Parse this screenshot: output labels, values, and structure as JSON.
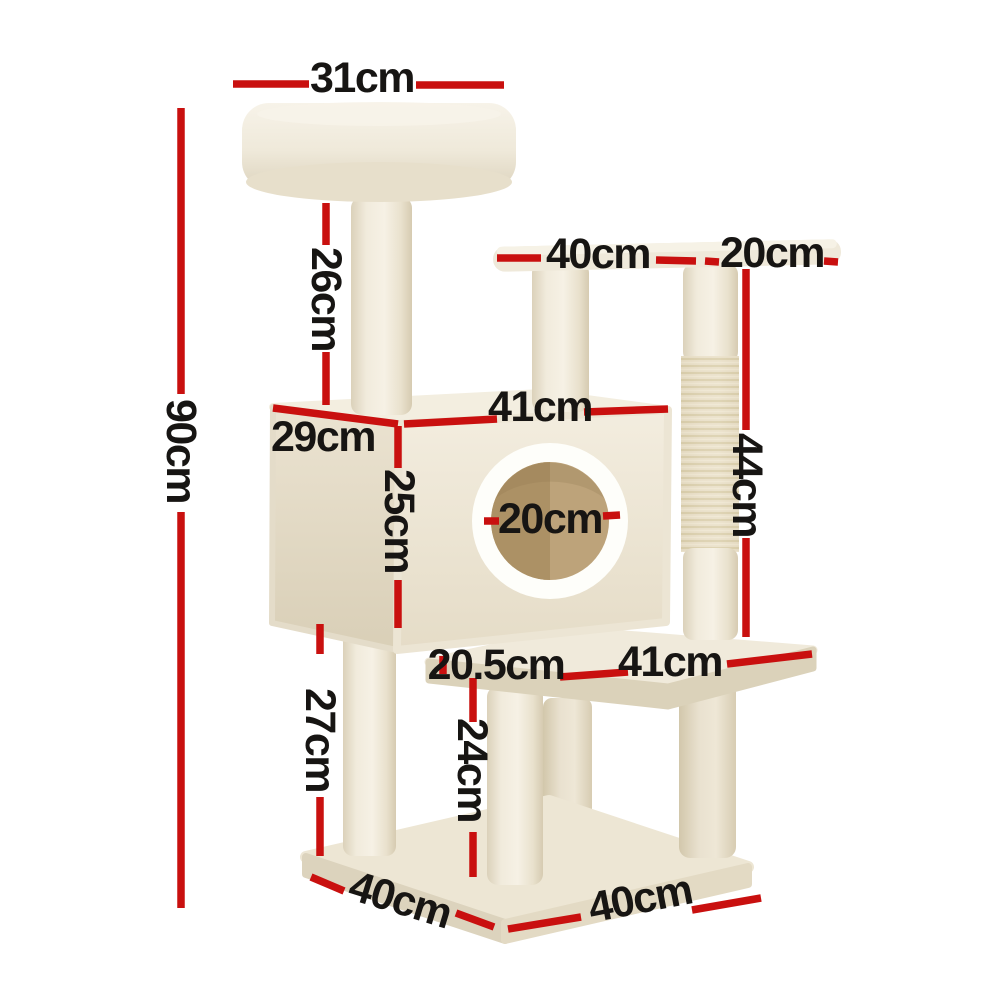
{
  "image": {
    "description": "Beige plush cat tree / scratching post product photo annotated with red dimension lines",
    "background": "#ffffff"
  },
  "colors": {
    "dimension_line": "#c9100f",
    "label_text": "#171513",
    "plush_light": "#f4efe3",
    "plush_mid": "#ece4d2",
    "plush_shadow": "#dcd2bb",
    "sisal": "#eae0c8",
    "hole_ring": "#fefefa",
    "hole_inner": "#bda37a",
    "hole_inner_dark": "#ac9165"
  },
  "dimensions": {
    "top_bed_width": {
      "label": "31cm"
    },
    "total_height": {
      "label": "90cm"
    },
    "top_post_height": {
      "label": "26cm"
    },
    "mid_platform_length": {
      "label": "40cm"
    },
    "mid_platform_overhang": {
      "label": "20cm"
    },
    "condo_width": {
      "label": "41cm"
    },
    "condo_depth": {
      "label": "29cm"
    },
    "condo_height": {
      "label": "25cm"
    },
    "hole_diameter": {
      "label": "20cm"
    },
    "sisal_post_height": {
      "label": "44cm"
    },
    "lower_platform_inset": {
      "label": "20.5cm"
    },
    "lower_platform_length": {
      "label": "41cm"
    },
    "left_post_height": {
      "label": "27cm"
    },
    "front_post_height": {
      "label": "24cm"
    },
    "base_depth": {
      "label": "40cm"
    },
    "base_width": {
      "label": "40cm"
    }
  }
}
